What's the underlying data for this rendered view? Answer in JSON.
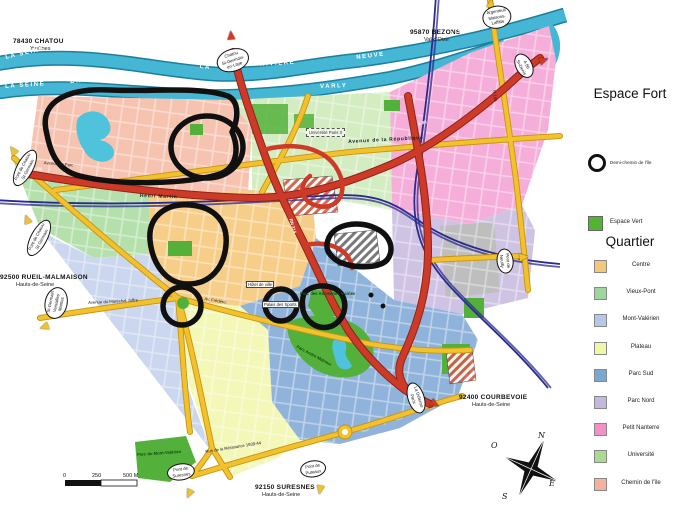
{
  "legend": {
    "title_fort": "Espace Fort",
    "fort_item": "Demi-chemin de l'île",
    "vert_item": "Espace Vert",
    "title_quartier": "Quartier",
    "colors": {
      "espace_vert": "#55B332"
    },
    "quartiers": [
      {
        "label": "Centre",
        "color": "#F2C979"
      },
      {
        "label": "Vieux-Pont",
        "color": "#9FD69B"
      },
      {
        "label": "Mont-Valérien",
        "color": "#B5C8E8"
      },
      {
        "label": "Plateau",
        "color": "#EFF6A6"
      },
      {
        "label": "Parc Sud",
        "color": "#7AA8D2"
      },
      {
        "label": "Parc Nord",
        "color": "#C6B7DE"
      },
      {
        "label": "Petit Nanterre",
        "color": "#F490C6"
      },
      {
        "label": "Université",
        "color": "#A9DB90"
      },
      {
        "label": "Chemin de l'île",
        "color": "#F6B29E"
      }
    ]
  },
  "map": {
    "compass": {
      "n": "N",
      "s": "S",
      "e": "E",
      "o": "O"
    },
    "scale": {
      "t0": "0",
      "t1": "250",
      "t2": "500 M"
    },
    "labels": [
      {
        "t": "78430 CHATOU",
        "c": "city",
        "x": 13,
        "y": 38,
        "r": 0
      },
      {
        "t": "Yvelines",
        "c": "dept",
        "x": 30,
        "y": 46,
        "r": 0
      },
      {
        "t": "95870 BEZONS",
        "c": "city",
        "x": 410,
        "y": 29,
        "r": 0
      },
      {
        "t": "Val-d'Oise",
        "c": "dept",
        "x": 424,
        "y": 37,
        "r": 0
      },
      {
        "t": "92500 RUEIL-MALMAISON",
        "c": "city",
        "x": 0,
        "y": 274,
        "r": 0
      },
      {
        "t": "Hauts-de-Seine",
        "c": "dept",
        "x": 16,
        "y": 282,
        "r": 0
      },
      {
        "t": "92400 COURBEVOIE",
        "c": "city",
        "x": 459,
        "y": 394,
        "r": 0
      },
      {
        "t": "Hauts-de-Seine",
        "c": "dept",
        "x": 472,
        "y": 402,
        "r": 0
      },
      {
        "t": "92150 SURESNES",
        "c": "city",
        "x": 255,
        "y": 484,
        "r": 0
      },
      {
        "t": "Hauts-de-Seine",
        "c": "dept",
        "x": 262,
        "y": 492,
        "r": 0
      },
      {
        "t": "LA SEINE",
        "c": "river",
        "x": 5,
        "y": 55,
        "r": -13
      },
      {
        "t": "BRAS",
        "c": "river",
        "x": 86,
        "y": 45,
        "r": -6
      },
      {
        "t": "DE",
        "c": "river",
        "x": 148,
        "y": 53,
        "r": 7
      },
      {
        "t": "LA",
        "c": "river",
        "x": 200,
        "y": 64,
        "r": 5
      },
      {
        "t": "RIVIERE",
        "c": "river",
        "x": 260,
        "y": 62,
        "r": -4
      },
      {
        "t": "NEUVE",
        "c": "river",
        "x": 356,
        "y": 55,
        "r": -7
      },
      {
        "t": "LA SEINE",
        "c": "river",
        "x": 444,
        "y": 33,
        "r": -14
      },
      {
        "t": "LA SEINE",
        "c": "river",
        "x": 5,
        "y": 84,
        "r": -4
      },
      {
        "t": "BRAS",
        "c": "river",
        "x": 70,
        "y": 79,
        "r": -4
      },
      {
        "t": "VARLY",
        "c": "river",
        "x": 320,
        "y": 84,
        "r": -2
      },
      {
        "t": "Avenue  de  la  République",
        "c": "road",
        "x": 348,
        "y": 139,
        "r": -3
      },
      {
        "t": "Henri  Martin",
        "c": "road",
        "x": 140,
        "y": 193,
        "r": 2
      },
      {
        "t": "Avenue du Maréchal Joffre",
        "c": "roadtiny",
        "x": 88,
        "y": 300,
        "r": -3
      },
      {
        "t": "Av. Frédéric",
        "c": "roadtiny",
        "x": 205,
        "y": 296,
        "r": 10
      },
      {
        "t": "A 86",
        "c": "roadwhite",
        "x": 417,
        "y": 122,
        "r": -18
      },
      {
        "t": "A 86",
        "c": "roadwhite",
        "x": 33,
        "y": 166,
        "r": 4
      },
      {
        "t": "Avenue du Parc",
        "c": "roadtiny",
        "x": 44,
        "y": 160,
        "r": 5
      },
      {
        "t": "RN 314",
        "c": "roadwhite",
        "x": 293,
        "y": 218,
        "r": 72
      },
      {
        "t": "N 186",
        "c": "roadtiny",
        "x": 497,
        "y": 90,
        "r": 84
      },
      {
        "t": "Rue de la Résistance 1939-44",
        "c": "roadtiny",
        "x": 205,
        "y": 449,
        "r": -9
      },
      {
        "t": "Hôtel de ville",
        "c": "placebox",
        "x": 246,
        "y": 281,
        "r": 0
      },
      {
        "t": "Palais des Sports",
        "c": "placebox",
        "x": 262,
        "y": 301,
        "r": 0
      },
      {
        "t": "Parc des Anciennes Mairies",
        "c": "placegreen",
        "x": 300,
        "y": 291,
        "r": 0
      },
      {
        "t": "Parc du Mont-Valérien",
        "c": "placegreen",
        "x": 137,
        "y": 452,
        "r": -4
      },
      {
        "t": "Parc André Malraux",
        "c": "placegreen",
        "x": 298,
        "y": 344,
        "r": 28
      },
      {
        "t": "Université Paris X",
        "c": "placedash",
        "x": 306,
        "y": 128,
        "r": 0
      }
    ],
    "signs": [
      {
        "lines": [
          "Chatou",
          "St-Germain-",
          "en-Laye"
        ],
        "x": 233,
        "y": 60,
        "r": -18,
        "ac": "#CE3A28",
        "ax": 231,
        "ay": 35,
        "ar": -95
      },
      {
        "lines": [
          "Argenteuil",
          "Maisons-",
          "Laffitte"
        ],
        "x": 497,
        "y": 17,
        "r": -10,
        "ac": "#F2C12E",
        "ax": 491,
        "ay": 3,
        "ar": -80
      },
      {
        "lines": [
          "A 86",
          "St-Denis"
        ],
        "x": 524,
        "y": 66,
        "r": 62,
        "ac": "#CE3A28",
        "ax": 544,
        "ay": 60,
        "ar": -20
      },
      {
        "lines": [
          "Pont de Chatou",
          "St-Germain"
        ],
        "x": 25,
        "y": 168,
        "r": -62,
        "ac": "#F2C12E",
        "ax": 13,
        "ay": 150,
        "ar": -125
      },
      {
        "lines": [
          "Pont de Chatou",
          "St-Germain"
        ],
        "x": 39,
        "y": 238,
        "r": -62,
        "ac": "#F2C12E",
        "ax": 27,
        "ay": 219,
        "ar": -110
      },
      {
        "lines": [
          "St-Germain",
          "Versailles",
          "Mantes"
        ],
        "x": 56,
        "y": 303,
        "r": -78,
        "ac": "#F2C12E",
        "ax": 44,
        "ay": 327,
        "ar": 160
      },
      {
        "lines": [
          "Pont de",
          "Suresnes"
        ],
        "x": 181,
        "y": 472,
        "r": -8,
        "ac": "#F2C12E",
        "ax": 189,
        "ay": 494,
        "ar": 115
      },
      {
        "lines": [
          "Pont de",
          "Puteaux"
        ],
        "x": 313,
        "y": 469,
        "r": -8,
        "ac": "#F2C12E",
        "ax": 320,
        "ay": 490,
        "ar": 100
      },
      {
        "lines": [
          "Pont de",
          "Neuilly"
        ],
        "x": 505,
        "y": 261,
        "r": 84,
        "ac": "#F2C12E",
        "ax": 524,
        "ay": 257,
        "ar": -5
      },
      {
        "lines": [
          "La Défense",
          "Paris"
        ],
        "x": 416,
        "y": 398,
        "r": 72,
        "ac": "#CE3A28",
        "ax": 435,
        "ay": 404,
        "ar": 30
      }
    ]
  }
}
